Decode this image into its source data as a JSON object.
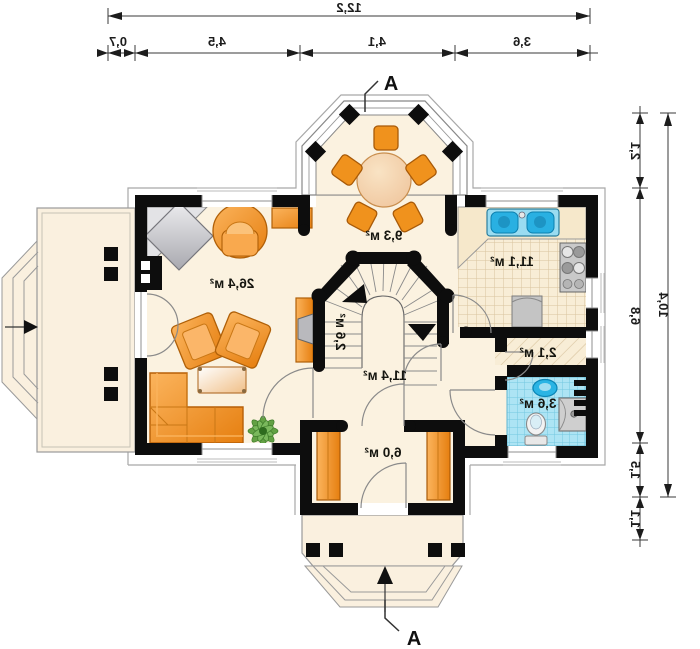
{
  "plan": {
    "drawing_type": "ground-floor-plan-mirrored",
    "unit": "м²",
    "section_letter": "A",
    "rooms": {
      "living": {
        "area": "26,4 м²"
      },
      "dining": {
        "area": "9,3 м²"
      },
      "kitchen": {
        "area": "11,1 м²"
      },
      "stairs": {
        "area": "2,6 м²"
      },
      "hall": {
        "area": "11,4 м²"
      },
      "wc": {
        "area": "2,1 м²"
      },
      "bath": {
        "area": "3,6 м²"
      },
      "entry": {
        "area": "6,0 м²"
      }
    },
    "dimensions": {
      "top_total": "12,2",
      "top_segments": [
        "0,7",
        "4,5",
        "4,1",
        "3,6"
      ],
      "right_total": "10,4",
      "right_segments": [
        "2,1",
        "6,8",
        "1,5",
        "1,1"
      ]
    },
    "colors": {
      "wall": "#0d0d0d",
      "floor": "#fbf2e0",
      "furniture_orange": "#f0921e",
      "bath_tile": "#ade4f4",
      "fixture_blue": "#2ab4e4",
      "dimension_line": "#3a3a3a"
    }
  }
}
